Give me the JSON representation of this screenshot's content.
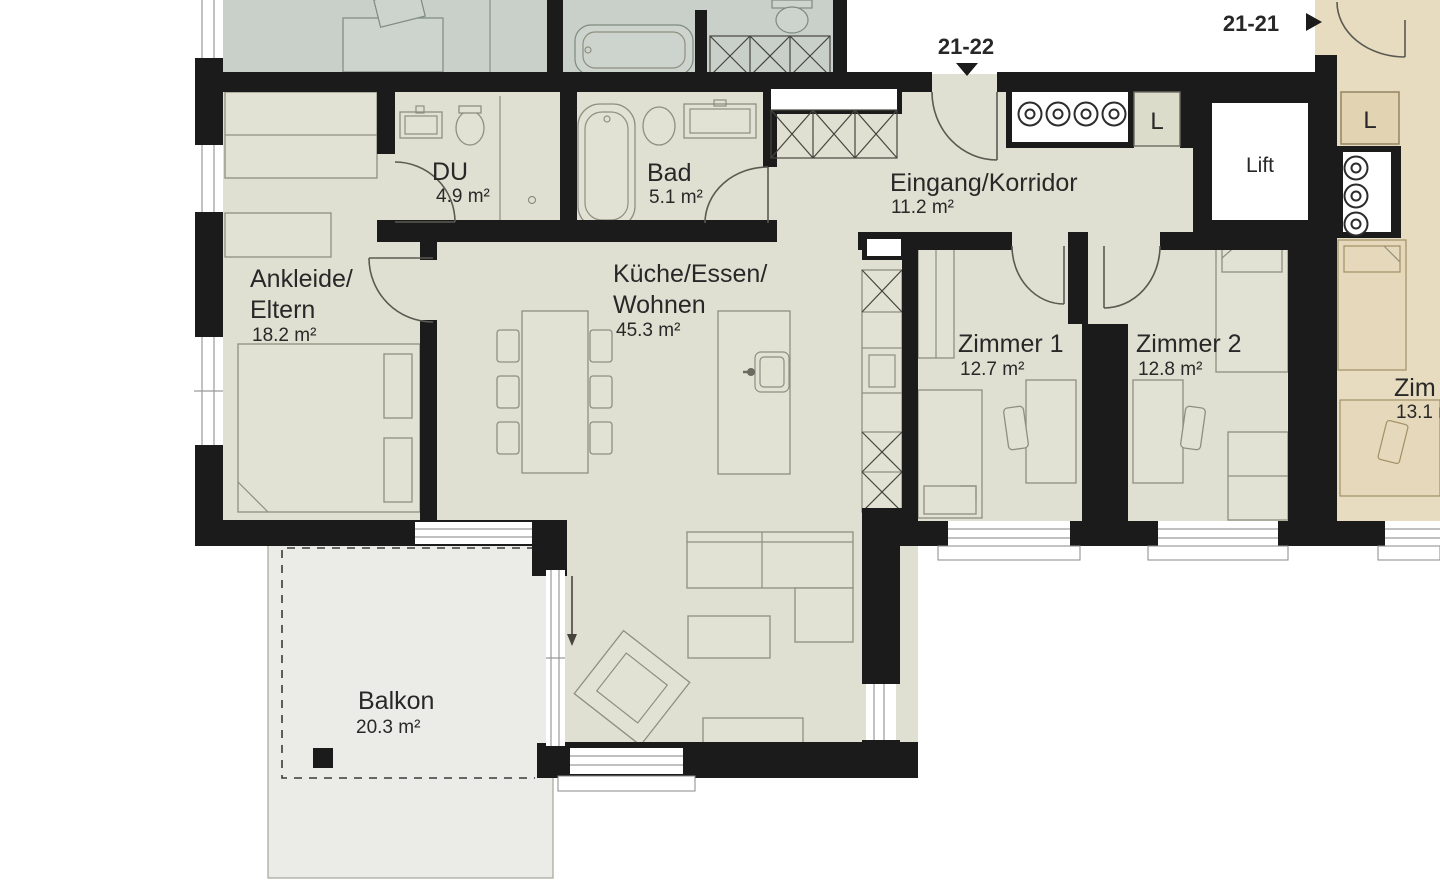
{
  "colors": {
    "wall": "#1b1b1b",
    "main_floor": "#e0e0d2",
    "neighbor_floor": "#c9cfc9",
    "adjacent_floor": "#e8dcc0",
    "balcony_floor": "#ebece7",
    "shaft_box_main": "#dcdccb",
    "shaft_box_adjacent": "#e2d3b2",
    "text": "#282828"
  },
  "units": {
    "current": {
      "label": "21-22"
    },
    "adjacent": {
      "label": "21-21"
    }
  },
  "rooms": {
    "ankleide": {
      "name_line1": "Ankleide/",
      "name_line2": "Eltern",
      "area": "18.2 m²"
    },
    "du": {
      "name": "DU",
      "area": "4.9 m²"
    },
    "bad": {
      "name": "Bad",
      "area": "5.1 m²"
    },
    "eingang": {
      "name": "Eingang/Korridor",
      "area": "11.2 m²"
    },
    "kueche": {
      "name_line1": "Küche/Essen/",
      "name_line2": "Wohnen",
      "area": "45.3 m²"
    },
    "zimmer1": {
      "name": "Zimmer 1",
      "area": "12.7 m²"
    },
    "zimmer2": {
      "name": "Zimmer 2",
      "area": "12.8 m²"
    },
    "balkon": {
      "name": "Balkon",
      "area": "20.3 m²"
    },
    "lift": {
      "name": "Lift"
    },
    "shaft_main": {
      "name": "L"
    },
    "shaft_adjacent": {
      "name": "L"
    },
    "adjacent_room": {
      "name_clipped": "Zim",
      "area_clipped": "13.1 m"
    }
  }
}
